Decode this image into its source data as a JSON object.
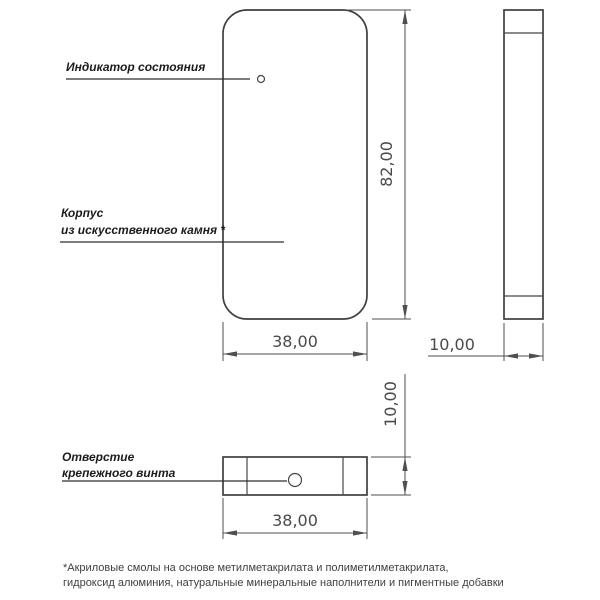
{
  "labels": {
    "indicator": "Индикатор состояния",
    "body": [
      "Корпус",
      "из искусственного камня *"
    ],
    "screw_hole": [
      "Отверстие",
      "крепежного винта"
    ]
  },
  "dimensions": {
    "front_height_mm": "82,00",
    "front_width_mm": "38,00",
    "side_thickness_mm": "10,00",
    "bottom_width_mm": "38,00",
    "bottom_thickness_mm": "10,00"
  },
  "footnote": [
    "*Акриловые смолы на основе метилметакрилата и полиметилметакрилата,",
    "гидроксид алюминия, натуральные минеральные наполнители и пигментные добавки"
  ],
  "colors": {
    "line": "#3f3f3f",
    "dimension_text": "#4a4a4a",
    "label_text": "#1c1c1c",
    "background": "#ffffff"
  }
}
